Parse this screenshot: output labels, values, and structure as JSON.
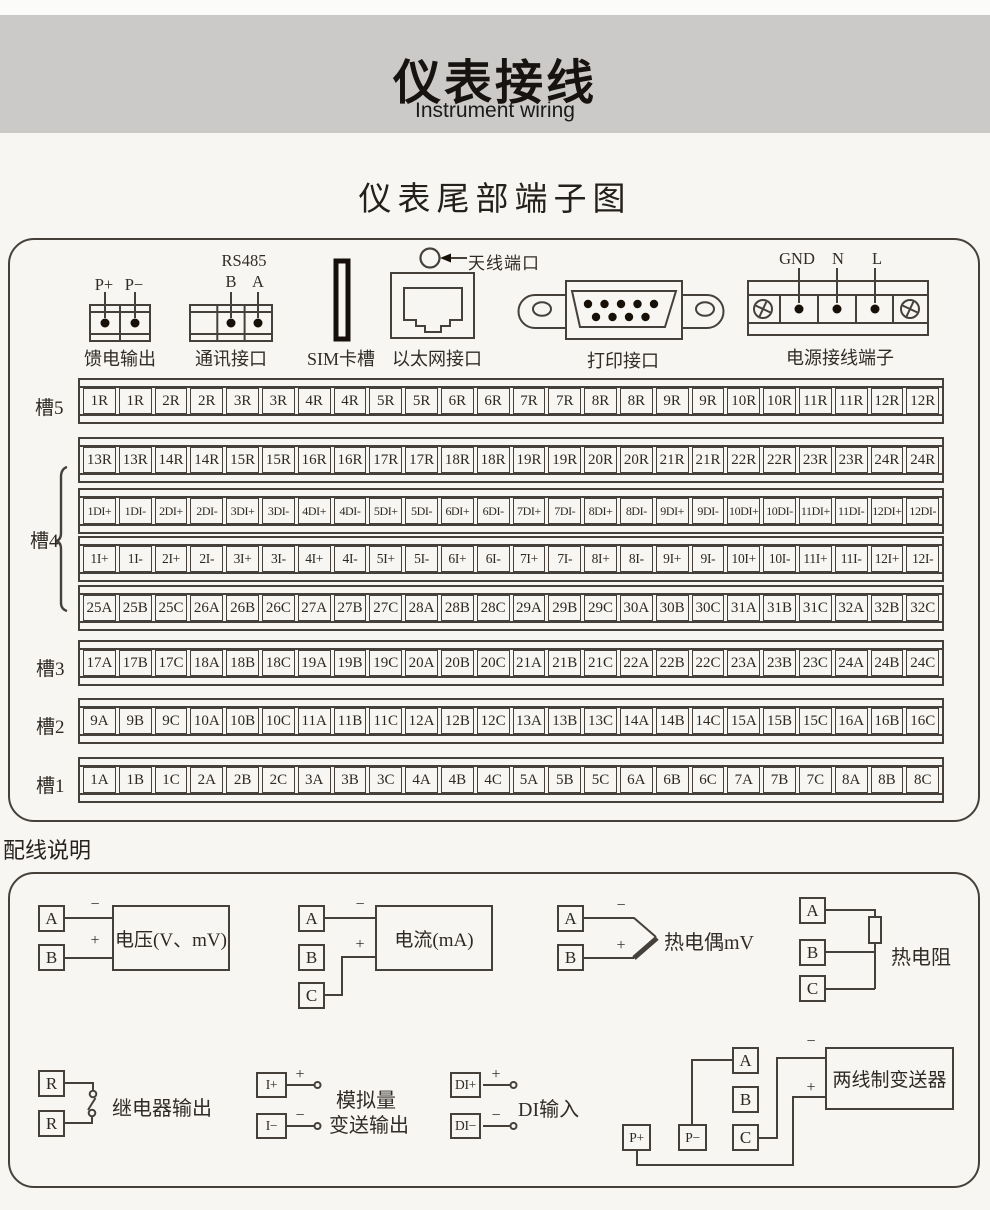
{
  "header": {
    "title": "仪表接线",
    "subtitle": "Instrument wiring"
  },
  "terminal_section": {
    "title": "仪表尾部端子图",
    "connectors": {
      "feed": {
        "pin1": "P+",
        "pin2": "P−",
        "caption": "馈电输出"
      },
      "comm": {
        "title": "RS485",
        "pin1": "B",
        "pin2": "A",
        "caption": "通讯接口"
      },
      "sim": {
        "caption": "SIM卡槽"
      },
      "ethernet": {
        "caption": "以太网接口"
      },
      "antenna": {
        "caption": "天线端口"
      },
      "printer": {
        "caption": "打印接口"
      },
      "power": {
        "pin1": "GND",
        "pin2": "N",
        "pin3": "L",
        "caption": "电源接线端子"
      }
    },
    "slot_labels": [
      "槽5",
      "槽4",
      "槽3",
      "槽2",
      "槽1"
    ],
    "rows": [
      [
        "1R",
        "1R",
        "2R",
        "2R",
        "3R",
        "3R",
        "4R",
        "4R",
        "5R",
        "5R",
        "6R",
        "6R",
        "7R",
        "7R",
        "8R",
        "8R",
        "9R",
        "9R",
        "10R",
        "10R",
        "11R",
        "11R",
        "12R",
        "12R"
      ],
      [
        "13R",
        "13R",
        "14R",
        "14R",
        "15R",
        "15R",
        "16R",
        "16R",
        "17R",
        "17R",
        "18R",
        "18R",
        "19R",
        "19R",
        "20R",
        "20R",
        "21R",
        "21R",
        "22R",
        "22R",
        "23R",
        "23R",
        "24R",
        "24R"
      ],
      [
        "1DI+",
        "1DI-",
        "2DI+",
        "2DI-",
        "3DI+",
        "3DI-",
        "4DI+",
        "4DI-",
        "5DI+",
        "5DI-",
        "6DI+",
        "6DI-",
        "7DI+",
        "7DI-",
        "8DI+",
        "8DI-",
        "9DI+",
        "9DI-",
        "10DI+",
        "10DI-",
        "11DI+",
        "11DI-",
        "12DI+",
        "12DI-"
      ],
      [
        "1I+",
        "1I-",
        "2I+",
        "2I-",
        "3I+",
        "3I-",
        "4I+",
        "4I-",
        "5I+",
        "5I-",
        "6I+",
        "6I-",
        "7I+",
        "7I-",
        "8I+",
        "8I-",
        "9I+",
        "9I-",
        "10I+",
        "10I-",
        "11I+",
        "11I-",
        "12I+",
        "12I-"
      ],
      [
        "25A",
        "25B",
        "25C",
        "26A",
        "26B",
        "26C",
        "27A",
        "27B",
        "27C",
        "28A",
        "28B",
        "28C",
        "29A",
        "29B",
        "29C",
        "30A",
        "30B",
        "30C",
        "31A",
        "31B",
        "31C",
        "32A",
        "32B",
        "32C"
      ],
      [
        "17A",
        "17B",
        "17C",
        "18A",
        "18B",
        "18C",
        "19A",
        "19B",
        "19C",
        "20A",
        "20B",
        "20C",
        "21A",
        "21B",
        "21C",
        "22A",
        "22B",
        "22C",
        "23A",
        "23B",
        "23C",
        "24A",
        "24B",
        "24C"
      ],
      [
        "9A",
        "9B",
        "9C",
        "10A",
        "10B",
        "10C",
        "11A",
        "11B",
        "11C",
        "12A",
        "12B",
        "12C",
        "13A",
        "13B",
        "13C",
        "14A",
        "14B",
        "14C",
        "15A",
        "15B",
        "15C",
        "16A",
        "16B",
        "16C"
      ],
      [
        "1A",
        "1B",
        "1C",
        "2A",
        "2B",
        "2C",
        "3A",
        "3B",
        "3C",
        "4A",
        "4B",
        "4C",
        "5A",
        "5B",
        "5C",
        "6A",
        "6B",
        "6C",
        "7A",
        "7B",
        "7C",
        "8A",
        "8B",
        "8C"
      ]
    ]
  },
  "wiring_section": {
    "title": "配线说明",
    "voltage": {
      "t1": "A",
      "t2": "B",
      "minus": "−",
      "plus": "+",
      "device": "电压(V、mV)"
    },
    "current": {
      "t1": "A",
      "t2": "B",
      "t3": "C",
      "minus": "−",
      "plus": "+",
      "device": "电流(mA)"
    },
    "thermocouple": {
      "t1": "A",
      "t2": "B",
      "minus": "−",
      "plus": "+",
      "label": "热电偶mV"
    },
    "rtd": {
      "t1": "A",
      "t2": "B",
      "t3": "C",
      "label": "热电阻"
    },
    "relay": {
      "t1": "R",
      "t2": "R",
      "label": "继电器输出"
    },
    "analog": {
      "t1": "I+",
      "t2": "I−",
      "plus": "+",
      "minus": "−",
      "label1": "模拟量",
      "label2": "变送输出"
    },
    "di": {
      "t1": "DI+",
      "t2": "DI−",
      "plus": "+",
      "minus": "−",
      "label": "DI输入"
    },
    "transmitter": {
      "tA": "A",
      "tB": "B",
      "tC": "C",
      "tP1": "P+",
      "tP2": "P−",
      "minus": "−",
      "plus": "+",
      "device": "两线制变送器"
    }
  },
  "colors": {
    "line": "#45403a",
    "banner": "#cbcac8",
    "background": "#f7f6f3",
    "dot": "#171007"
  }
}
